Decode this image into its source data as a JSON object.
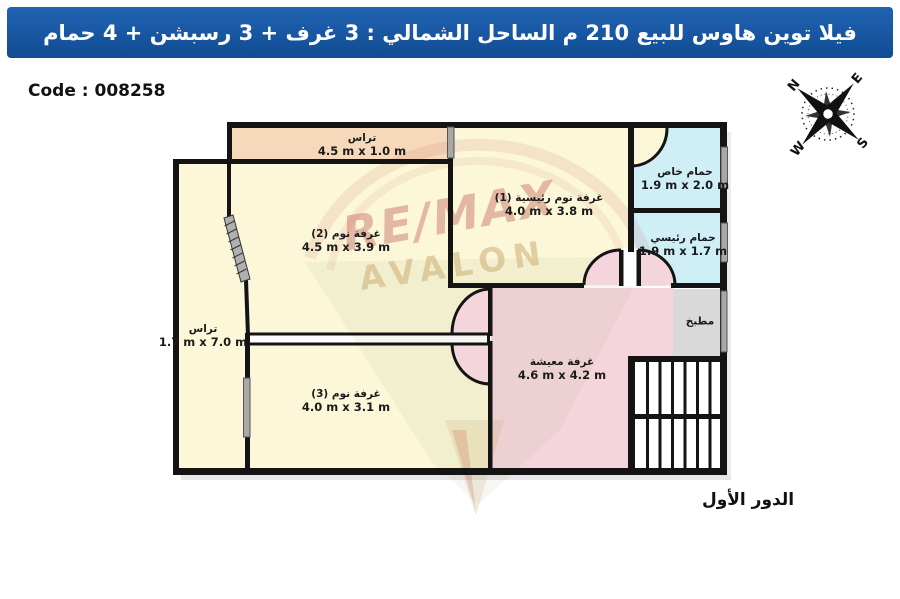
{
  "header": {
    "title": "فيلا توين هاوس للبيع 210 م الساحل الشمالي :  3 غرف + 3 رسبشن + 4 حمام"
  },
  "code_label": "Code : 008258",
  "floor_label": "الدور الأول",
  "compass": {
    "n": "N",
    "e": "E",
    "s": "S",
    "w": "W"
  },
  "watermark": {
    "line1": "RE/MAX",
    "line2": "AVALON"
  },
  "rooms": {
    "terrace_top": {
      "name": "تراس",
      "dims": "4.5 m x 1.0 m"
    },
    "bedroom_2": {
      "name": "غرفة نوم (2)",
      "dims": "4.5 m x 3.9 m"
    },
    "master_bedroom": {
      "name": "غرفة نوم رئيسية (1)",
      "dims": "4.0 m x 3.8 m"
    },
    "private_bathroom": {
      "name": "حمام خاص",
      "dims": "1.9 m x 2.0 m"
    },
    "main_bathroom": {
      "name": "حمام رئيسي",
      "dims": "1.9 m x 1.7 m"
    },
    "kitchen": {
      "name": "مطبخ"
    },
    "living_room": {
      "name": "غرفة معيشة",
      "dims": "4.6 m x 4.2 m"
    },
    "terrace_left": {
      "name": "تراس",
      "dims": "1.7 m x 7.0 m"
    },
    "bedroom_3": {
      "name": "غرفة نوم (3)",
      "dims": "4.0 m x 3.1 m"
    }
  },
  "colors": {
    "header_blue": "#1558a8",
    "room_cream": "#fbf7d8",
    "terrace_peach": "#f6d9bb",
    "living_pink": "#f5d5dc",
    "bathroom_blue": "#cfeef6",
    "kitchen_gray": "#d9d9d9",
    "wall_black": "#141414"
  }
}
